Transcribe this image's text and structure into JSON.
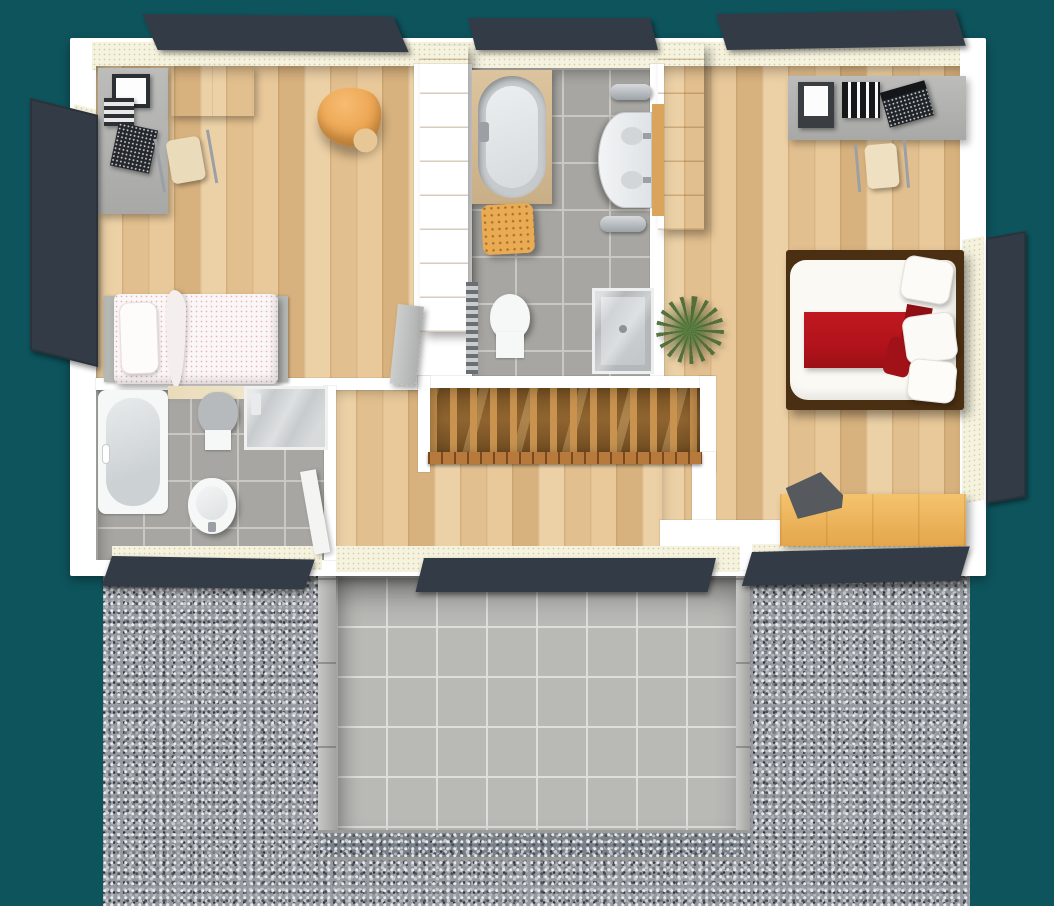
{
  "scene": {
    "type": "floor-plan-3d-render",
    "view": "top-down",
    "rooms": [
      {
        "id": "bedroom-left",
        "items": [
          "wall-cabinet",
          "desk",
          "monitor",
          "drawer-unit",
          "keyboard",
          "desk-chair",
          "lounge-chair",
          "single-bed",
          "wardrobe",
          "door"
        ]
      },
      {
        "id": "bathroom-main",
        "items": [
          "oval-bathtub",
          "laundry-basket",
          "towel-radiator",
          "bidet",
          "double-washbasin",
          "backsplash",
          "towel-rail-top",
          "towel-rail-bottom",
          "shower"
        ]
      },
      {
        "id": "bedroom-master",
        "items": [
          "wardrobe",
          "desk",
          "printer",
          "ring-binders",
          "laptop",
          "desk-chair",
          "double-bed",
          "red-runner",
          "pillows",
          "potted-plant",
          "sideboard-bench",
          "bag"
        ]
      },
      {
        "id": "bathroom-small",
        "items": [
          "bathtub",
          "toilet",
          "shower",
          "washbasin",
          "door",
          "shelf-strip"
        ]
      },
      {
        "id": "hallway",
        "items": [
          "stairwell",
          "balusters",
          "handrail"
        ]
      },
      {
        "id": "exterior",
        "items": [
          "gravel-yard",
          "sunken-patio",
          "patio-left-wall",
          "patio-right-wall",
          "drain-gravel-strip",
          "roof-window-left",
          "roof-window-center",
          "roof-window-right",
          "shutter-left",
          "shutter-right",
          "bottom-window-left",
          "bottom-window-center",
          "bottom-window-right",
          "cream-facade-strips"
        ]
      }
    ]
  },
  "colors": {
    "bg": "#0E545D",
    "wall": "#FFFFFF",
    "cream": "#F5F2DE",
    "wood-1": "#EDD1A6",
    "wood-2": "#E2BF8E",
    "wood-3": "#D8B27E",
    "stair-mid": "#8F6430",
    "stair-dark": "#6E4A1F",
    "baluster": "#C9934F",
    "rail": "#B8793C",
    "tile": "#A7A6A2",
    "grout": "#C9C8C3",
    "patio-tile": "#B9B9B6",
    "patio-grout": "#DEDEDB",
    "gravel": "#969AA0",
    "frame": "#333C46",
    "glass": "#CDD1D3",
    "orange": "#E9AC55",
    "orange-deep": "#D8973F",
    "red": "#B2131B",
    "red-deep": "#8F0F15",
    "white-fix": "#F6F7F7",
    "gray-fix": "#C6CACC",
    "desk": "#B3B3B1",
    "dark": "#24272B",
    "metal": "#9AA0A5",
    "plant": "#55703B",
    "bed-frame": "#4A2F12"
  }
}
